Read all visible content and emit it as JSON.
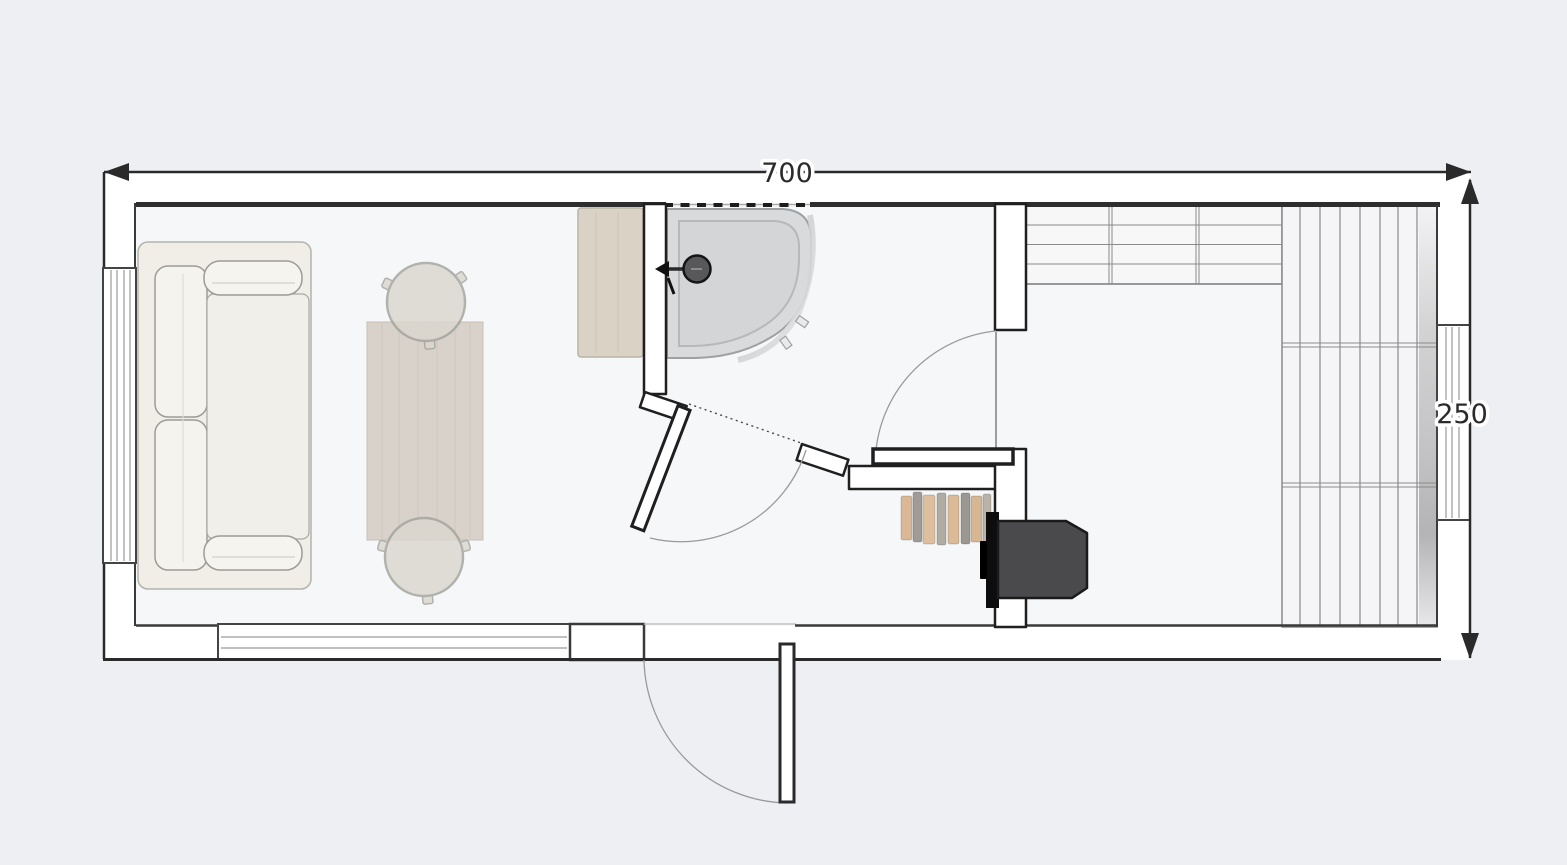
{
  "title": "Tiny-house floor plan, top view",
  "dimension_labels": {
    "width": "700",
    "depth": "250"
  },
  "rooms": [
    "living-area",
    "shower-room",
    "entry",
    "side-room"
  ],
  "furniture": [
    "sofa",
    "dining-table",
    "stool-top",
    "stool-bottom",
    "kitchen-counter",
    "corner-shower",
    "shower-mixer",
    "wood-stove",
    "firewood-stack",
    "shelving-unit",
    "slatted-bench"
  ],
  "openings": [
    "left-window",
    "bottom-window",
    "right-window",
    "shower-room-door",
    "side-room-door",
    "entrance-door"
  ],
  "colors": {
    "background": "#edeff3",
    "building": "#ffffff",
    "floor": "#f6f7f9",
    "wall": "#2e2e2e",
    "dimension": "#2a2a2a",
    "wood_table": "#d7d1c8",
    "counter": "#d9d2c5",
    "sofa": "#f0eee7",
    "stool": "#dbd7cf",
    "shower_tray": "#d8dadc",
    "stove_body": "#4a4a4c",
    "firewood": "#d7b28b",
    "slats": "#f5f5f7"
  }
}
